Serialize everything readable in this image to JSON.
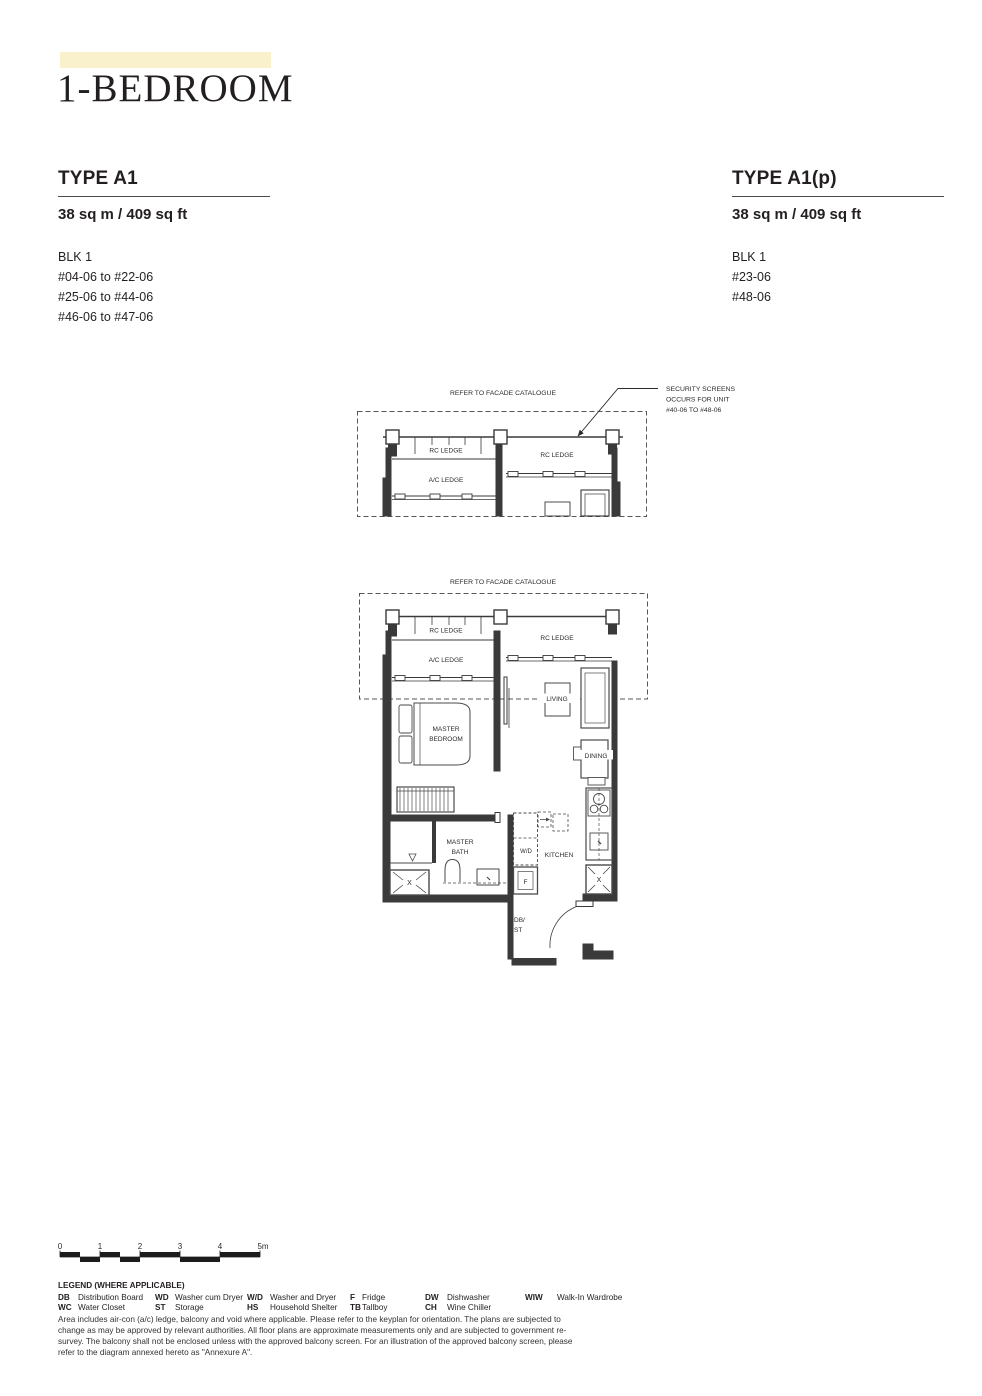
{
  "page": {
    "title": "1-BEDROOM"
  },
  "types": [
    {
      "name": "TYPE A1",
      "area": "38 sq m / 409 sq ft",
      "block": "BLK 1",
      "units": [
        "#04-06 to #22-06",
        "#25-06 to #44-06",
        "#46-06 to #47-06"
      ]
    },
    {
      "name": "TYPE A1(p)",
      "area": "38 sq m / 409 sq ft",
      "block": "BLK 1",
      "units": [
        "#23-06",
        "#48-06"
      ]
    }
  ],
  "facade_diagram": {
    "caption": "REFER TO FACADE CATALOGUE",
    "security_note_line1": "SECURITY SCREENS",
    "security_note_line2": "OCCURS FOR UNIT",
    "security_note_line3": "#40-06 TO #48-06",
    "rc_ledge": "RC LEDGE",
    "ac_ledge": "A/C LEDGE"
  },
  "floor_plan": {
    "caption": "REFER TO FACADE CATALOGUE",
    "rc_ledge": "RC LEDGE",
    "ac_ledge": "A/C LEDGE",
    "living": "LIVING",
    "dining": "DINING",
    "master": "MASTER",
    "bedroom": "BEDROOM",
    "bath": "BATH",
    "kitchen": "KITCHEN",
    "wd": "W/D",
    "fridge": "F",
    "db": "DB/",
    "st": "ST",
    "shaft": "X"
  },
  "scale_bar": {
    "ticks": [
      "0",
      "1",
      "2",
      "3",
      "4",
      "5m"
    ]
  },
  "legend": {
    "title": "LEGEND (WHERE APPLICABLE)",
    "columns": [
      [
        {
          "abbr": "DB",
          "label": "Distribution Board"
        },
        {
          "abbr": "WC",
          "label": "Water Closet"
        }
      ],
      [
        {
          "abbr": "WD",
          "label": "Washer cum Dryer"
        },
        {
          "abbr": "ST",
          "label": "Storage"
        }
      ],
      [
        {
          "abbr": "W/D",
          "label": "Washer and Dryer"
        },
        {
          "abbr": "HS",
          "label": "Household Shelter"
        }
      ],
      [
        {
          "abbr": "F",
          "label": "Fridge"
        },
        {
          "abbr": "TB",
          "label": "Tallboy"
        }
      ],
      [
        {
          "abbr": "DW",
          "label": "Dishwasher"
        },
        {
          "abbr": "CH",
          "label": "Wine Chiller"
        }
      ],
      [
        {
          "abbr": "WIW",
          "label": "Walk-In Wardrobe"
        }
      ]
    ]
  },
  "disclaimer": "Area includes air-con (a/c) ledge, balcony and void where applicable. Please refer to the keyplan for orientation. The plans are subjected to change as may be approved by relevant authorities. All floor plans are approximate measurements only and are subjected to government re-survey. The balcony shall not be enclosed unless with the approved balcony screen. For an illustration of the approved balcony screen, please refer to the diagram annexed hereto as \"Annexure A\".",
  "colors": {
    "accent_bar": "#f8f1cb",
    "line": "#3a3a3a",
    "text": "#231f20"
  }
}
